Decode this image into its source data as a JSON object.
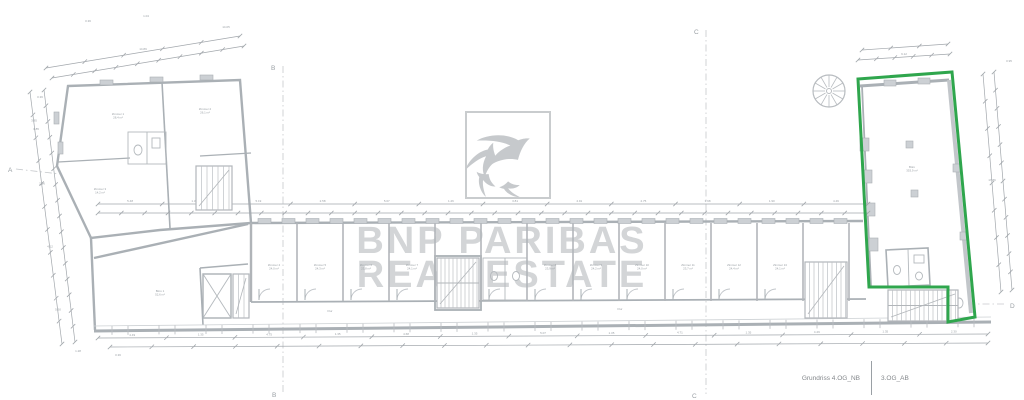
{
  "title_block": {
    "drawing_name": "Grundriss 4.OG_NB",
    "sheet_name": "3.OG_AB"
  },
  "watermark": {
    "line1": "BNP PARIBAS",
    "line2": "REAL ESTATE",
    "logo_name": "bnp-paribas-birds-logo",
    "birds": [
      {
        "x": 516,
        "y": 141,
        "s": 1.15,
        "r": -20
      },
      {
        "x": 487,
        "y": 151,
        "s": 0.85,
        "r": -62
      },
      {
        "x": 480,
        "y": 178,
        "s": 0.58,
        "r": -128
      },
      {
        "x": 505,
        "y": 189,
        "s": 0.5,
        "r": -172
      }
    ]
  },
  "grid": {
    "a": "A",
    "b": "B",
    "c": "C",
    "d": "D"
  },
  "colors": {
    "highlight_green": "#2fa64d",
    "plan_gray": "#aab0b5",
    "dimension_gray": "#a2a7ac",
    "watermark_gray": "#d3d5d7",
    "title_gray": "#83878b"
  },
  "plan": {
    "green_outline_points": "858,79 952,72 975,317 948,322 948,287 869,287",
    "partitions_x": [
      251,
      297,
      343,
      389,
      435,
      481,
      527,
      573,
      619,
      665,
      711,
      757,
      803,
      849
    ],
    "door_skip": [
      4,
      12
    ],
    "dims": [
      {
        "x1": 98,
        "y1": 204,
        "x2": 868,
        "y2": 204,
        "n": 13,
        "labels": [
          "5.48",
          "1.35",
          "5.19",
          "2.58",
          "5.07",
          "1.26",
          "3.81",
          "4.91",
          "2.75",
          "3.98",
          "1.90",
          "4.49"
        ]
      },
      {
        "x1": 98,
        "y1": 213,
        "x2": 868,
        "y2": 213,
        "n": 34,
        "labels": []
      },
      {
        "x1": 98,
        "y1": 338,
        "x2": 988,
        "y2": 334,
        "n": 14,
        "labels": [
          "4.49",
          "1.35",
          "4.75",
          "1.35",
          "4.68",
          "1.35",
          "5.07",
          "1.35",
          "4.71",
          "1.35",
          "4.49",
          "1.35",
          "2.30"
        ]
      },
      {
        "x1": 110,
        "y1": 347,
        "x2": 988,
        "y2": 343,
        "n": 22,
        "labels": []
      },
      {
        "x1": 30,
        "y1": 92,
        "x2": 62,
        "y2": 344,
        "n": 12,
        "labels": [
          "3.85",
          "2.96",
          "4.12",
          "5.60"
        ]
      },
      {
        "x1": 44,
        "y1": 90,
        "x2": 75,
        "y2": 342,
        "n": 17,
        "labels": []
      },
      {
        "x1": 46,
        "y1": 68,
        "x2": 240,
        "y2": 36,
        "n": 6,
        "labels": [
          "14.89"
        ]
      },
      {
        "x1": 52,
        "y1": 78,
        "x2": 244,
        "y2": 46,
        "n": 10,
        "labels": []
      },
      {
        "x1": 983,
        "y1": 74,
        "x2": 1001,
        "y2": 292,
        "n": 9,
        "labels": [
          "17.86"
        ]
      },
      {
        "x1": 994,
        "y1": 72,
        "x2": 1012,
        "y2": 290,
        "n": 13,
        "labels": []
      },
      {
        "x1": 858,
        "y1": 60,
        "x2": 950,
        "y2": 54,
        "n": 6,
        "labels": [
          "9.12"
        ]
      },
      {
        "x1": 862,
        "y1": 50,
        "x2": 948,
        "y2": 44,
        "n": 4,
        "labels": []
      }
    ],
    "scatter_labels": [
      {
        "x": 88,
        "y": 22,
        "t": "0.36"
      },
      {
        "x": 146,
        "y": 17,
        "t": "1.04"
      },
      {
        "x": 226,
        "y": 28,
        "t": "14.05"
      },
      {
        "x": 40,
        "y": 98,
        "t": "0.36"
      },
      {
        "x": 36,
        "y": 130,
        "t": "3.85"
      },
      {
        "x": 1009,
        "y": 62,
        "t": "0.95"
      },
      {
        "x": 78,
        "y": 352,
        "t": "1.28"
      },
      {
        "x": 118,
        "y": 356,
        "t": "0.36"
      }
    ],
    "room_labels": [
      {
        "x": 118,
        "y": 115,
        "lines": [
          "Zimmer 1",
          "28,4 m²"
        ]
      },
      {
        "x": 205,
        "y": 110,
        "lines": [
          "Zimmer 2",
          "26,1 m²"
        ]
      },
      {
        "x": 100,
        "y": 190,
        "lines": [
          "Zimmer 3",
          "14,2 m²"
        ]
      },
      {
        "x": 160,
        "y": 292,
        "lines": [
          "Büro 1",
          "52,6 m²"
        ]
      },
      {
        "x": 274,
        "y": 266,
        "lines": [
          "Zimmer 4",
          "24,0 m²"
        ]
      },
      {
        "x": 320,
        "y": 266,
        "lines": [
          "Zimmer 5",
          "24,3 m²"
        ]
      },
      {
        "x": 366,
        "y": 266,
        "lines": [
          "Zimmer 6",
          "23,8 m²"
        ]
      },
      {
        "x": 412,
        "y": 266,
        "lines": [
          "Zimmer 7",
          "24,1 m²"
        ]
      },
      {
        "x": 550,
        "y": 266,
        "lines": [
          "Zimmer 8",
          "23,9 m²"
        ]
      },
      {
        "x": 596,
        "y": 266,
        "lines": [
          "Zimmer 9",
          "24,2 m²"
        ]
      },
      {
        "x": 642,
        "y": 266,
        "lines": [
          "Zimmer 10",
          "24,0 m²"
        ]
      },
      {
        "x": 688,
        "y": 266,
        "lines": [
          "Zimmer 11",
          "23,7 m²"
        ]
      },
      {
        "x": 734,
        "y": 266,
        "lines": [
          "Zimmer 12",
          "24,4 m²"
        ]
      },
      {
        "x": 780,
        "y": 266,
        "lines": [
          "Zimmer 13",
          "24,1 m²"
        ]
      },
      {
        "x": 330,
        "y": 312,
        "lines": [
          "Flur"
        ]
      },
      {
        "x": 620,
        "y": 310,
        "lines": [
          "Flur"
        ]
      },
      {
        "x": 912,
        "y": 168,
        "lines": [
          "Büro",
          "353,9 m²"
        ]
      }
    ],
    "stairs": [
      {
        "x": 437,
        "y": 258,
        "w": 42,
        "h": 50,
        "step": 4,
        "mid": true
      },
      {
        "x": 805,
        "y": 262,
        "w": 42,
        "h": 56,
        "step": 4.5,
        "mid": false
      },
      {
        "x": 888,
        "y": 290,
        "w": 70,
        "h": 31,
        "step": 4.5,
        "mid": true
      },
      {
        "x": 196,
        "y": 166,
        "w": 36,
        "h": 44,
        "step": 5.5,
        "mid": false
      },
      {
        "x": 233,
        "y": 274,
        "w": 16,
        "h": 44,
        "step": 5.5,
        "mid": false
      }
    ]
  }
}
